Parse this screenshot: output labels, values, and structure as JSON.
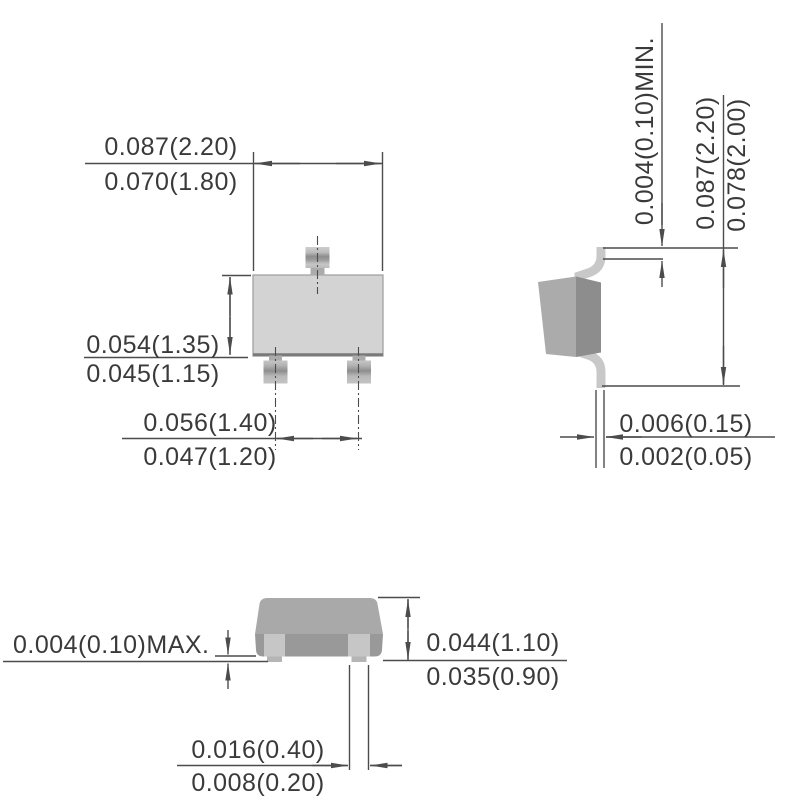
{
  "drawing_type": "package-outline-dimension-drawing",
  "colors": {
    "line": "#4c4c4c",
    "text": "#3a3a3a",
    "body_light": "#d3d3d3",
    "body_mid": "#a9a9a9",
    "body_dark": "#8d8d8d",
    "lead": "#c8c8c8"
  },
  "top_view": {
    "body_width": {
      "max": "0.087(2.20)",
      "min": "0.070(1.80)"
    },
    "body_height": {
      "max": "0.054(1.35)",
      "min": "0.045(1.15)"
    },
    "lead_pitch": {
      "max": "0.056(1.40)",
      "min": "0.047(1.20)"
    }
  },
  "side_view": {
    "lead_tip_clearance": "0.004(0.10)MIN.",
    "lead_span": {
      "max": "0.087(2.20)",
      "min": "0.078(2.00)"
    },
    "lead_thickness": {
      "max": "0.006(0.15)",
      "min": "0.002(0.05)"
    }
  },
  "front_view": {
    "standoff": "0.004(0.10)MAX.",
    "body_height": {
      "max": "0.044(1.10)",
      "min": "0.035(0.90)"
    },
    "lead_width": {
      "max": "0.016(0.40)",
      "min": "0.008(0.20)"
    }
  }
}
